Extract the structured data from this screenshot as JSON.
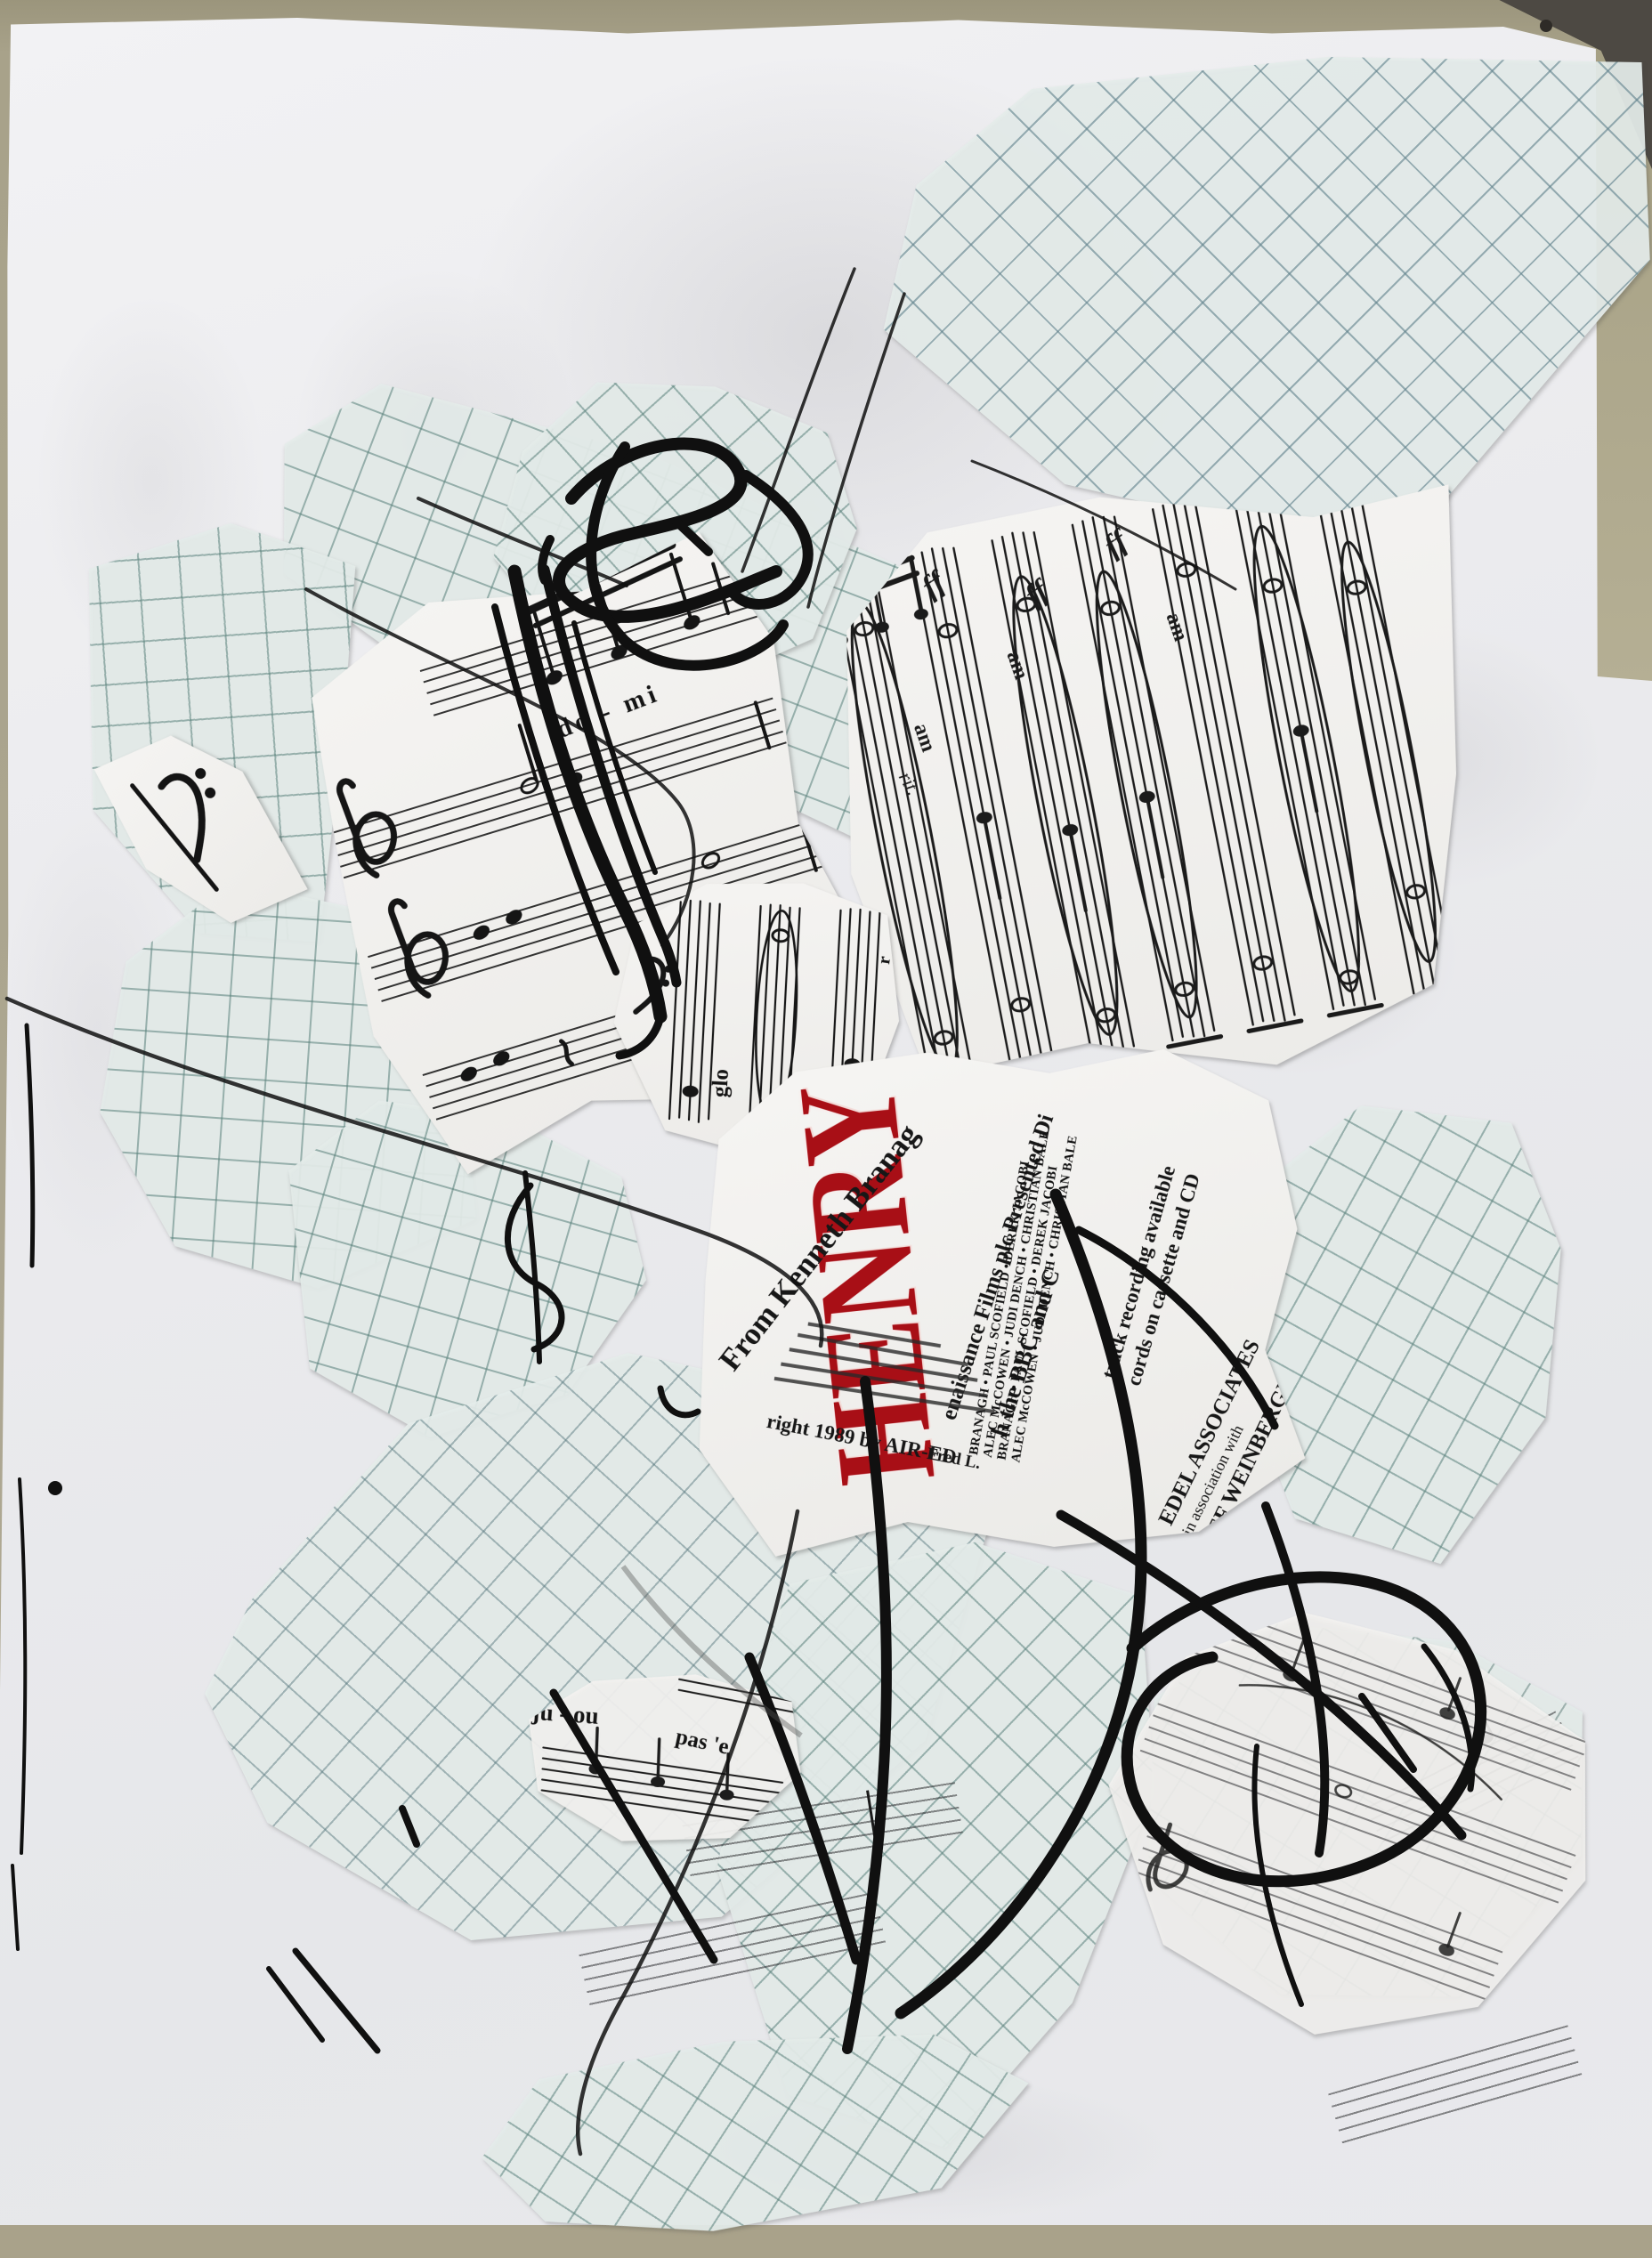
{
  "artwork": {
    "title": "Untitled mixed-media collage",
    "description": "Photograph of a collage on white paper: torn graph-paper pieces, torn sheet-music fragments, a torn Henry V (1989) soundtrack flyer and heavy black charcoal scribbles."
  },
  "flyer": {
    "title": "HENRY",
    "from_credit": "From Kenneth Branag",
    "renaissance_line": "enaissance Films plc Presented Di",
    "bbc_line": "h the BBC and C",
    "cast_lines": [
      "BRANAGH • PAUL SCOFIELD • DEREK JACOBI",
      "ALEC McCOWEN • JUDI DENCH • CHRISTIAN BALE"
    ],
    "soundtrack_line1": "track recording available",
    "soundtrack_line2": "cords on cassette and CD",
    "edel_line1": "EDEL ASSOCIATES",
    "edel_line2": "in association with",
    "edel_line3": "SEF WEINBERGER LTD",
    "copyright_line1": "right 1989 by AIR-ED",
    "copyright_line2": "Fred L."
  },
  "sheet_music": {
    "lyric_do_mi": "do  -  mi",
    "lyric_glo": "glo",
    "lyric_am": "am",
    "marking_rit": "rit.",
    "marking_ff": "ff",
    "plate_number": "B021",
    "letter_r": "r",
    "upside_lyric1": "ju - ou",
    "upside_lyric2": "pas 'e"
  },
  "colors": {
    "red_title": "#a80f16",
    "charcoal": "#101010",
    "grid_teal": "#5f8d89",
    "paper_white": "#f2f2f4",
    "table_olive": "#a59f83",
    "corner_dark": "#4d4943"
  }
}
